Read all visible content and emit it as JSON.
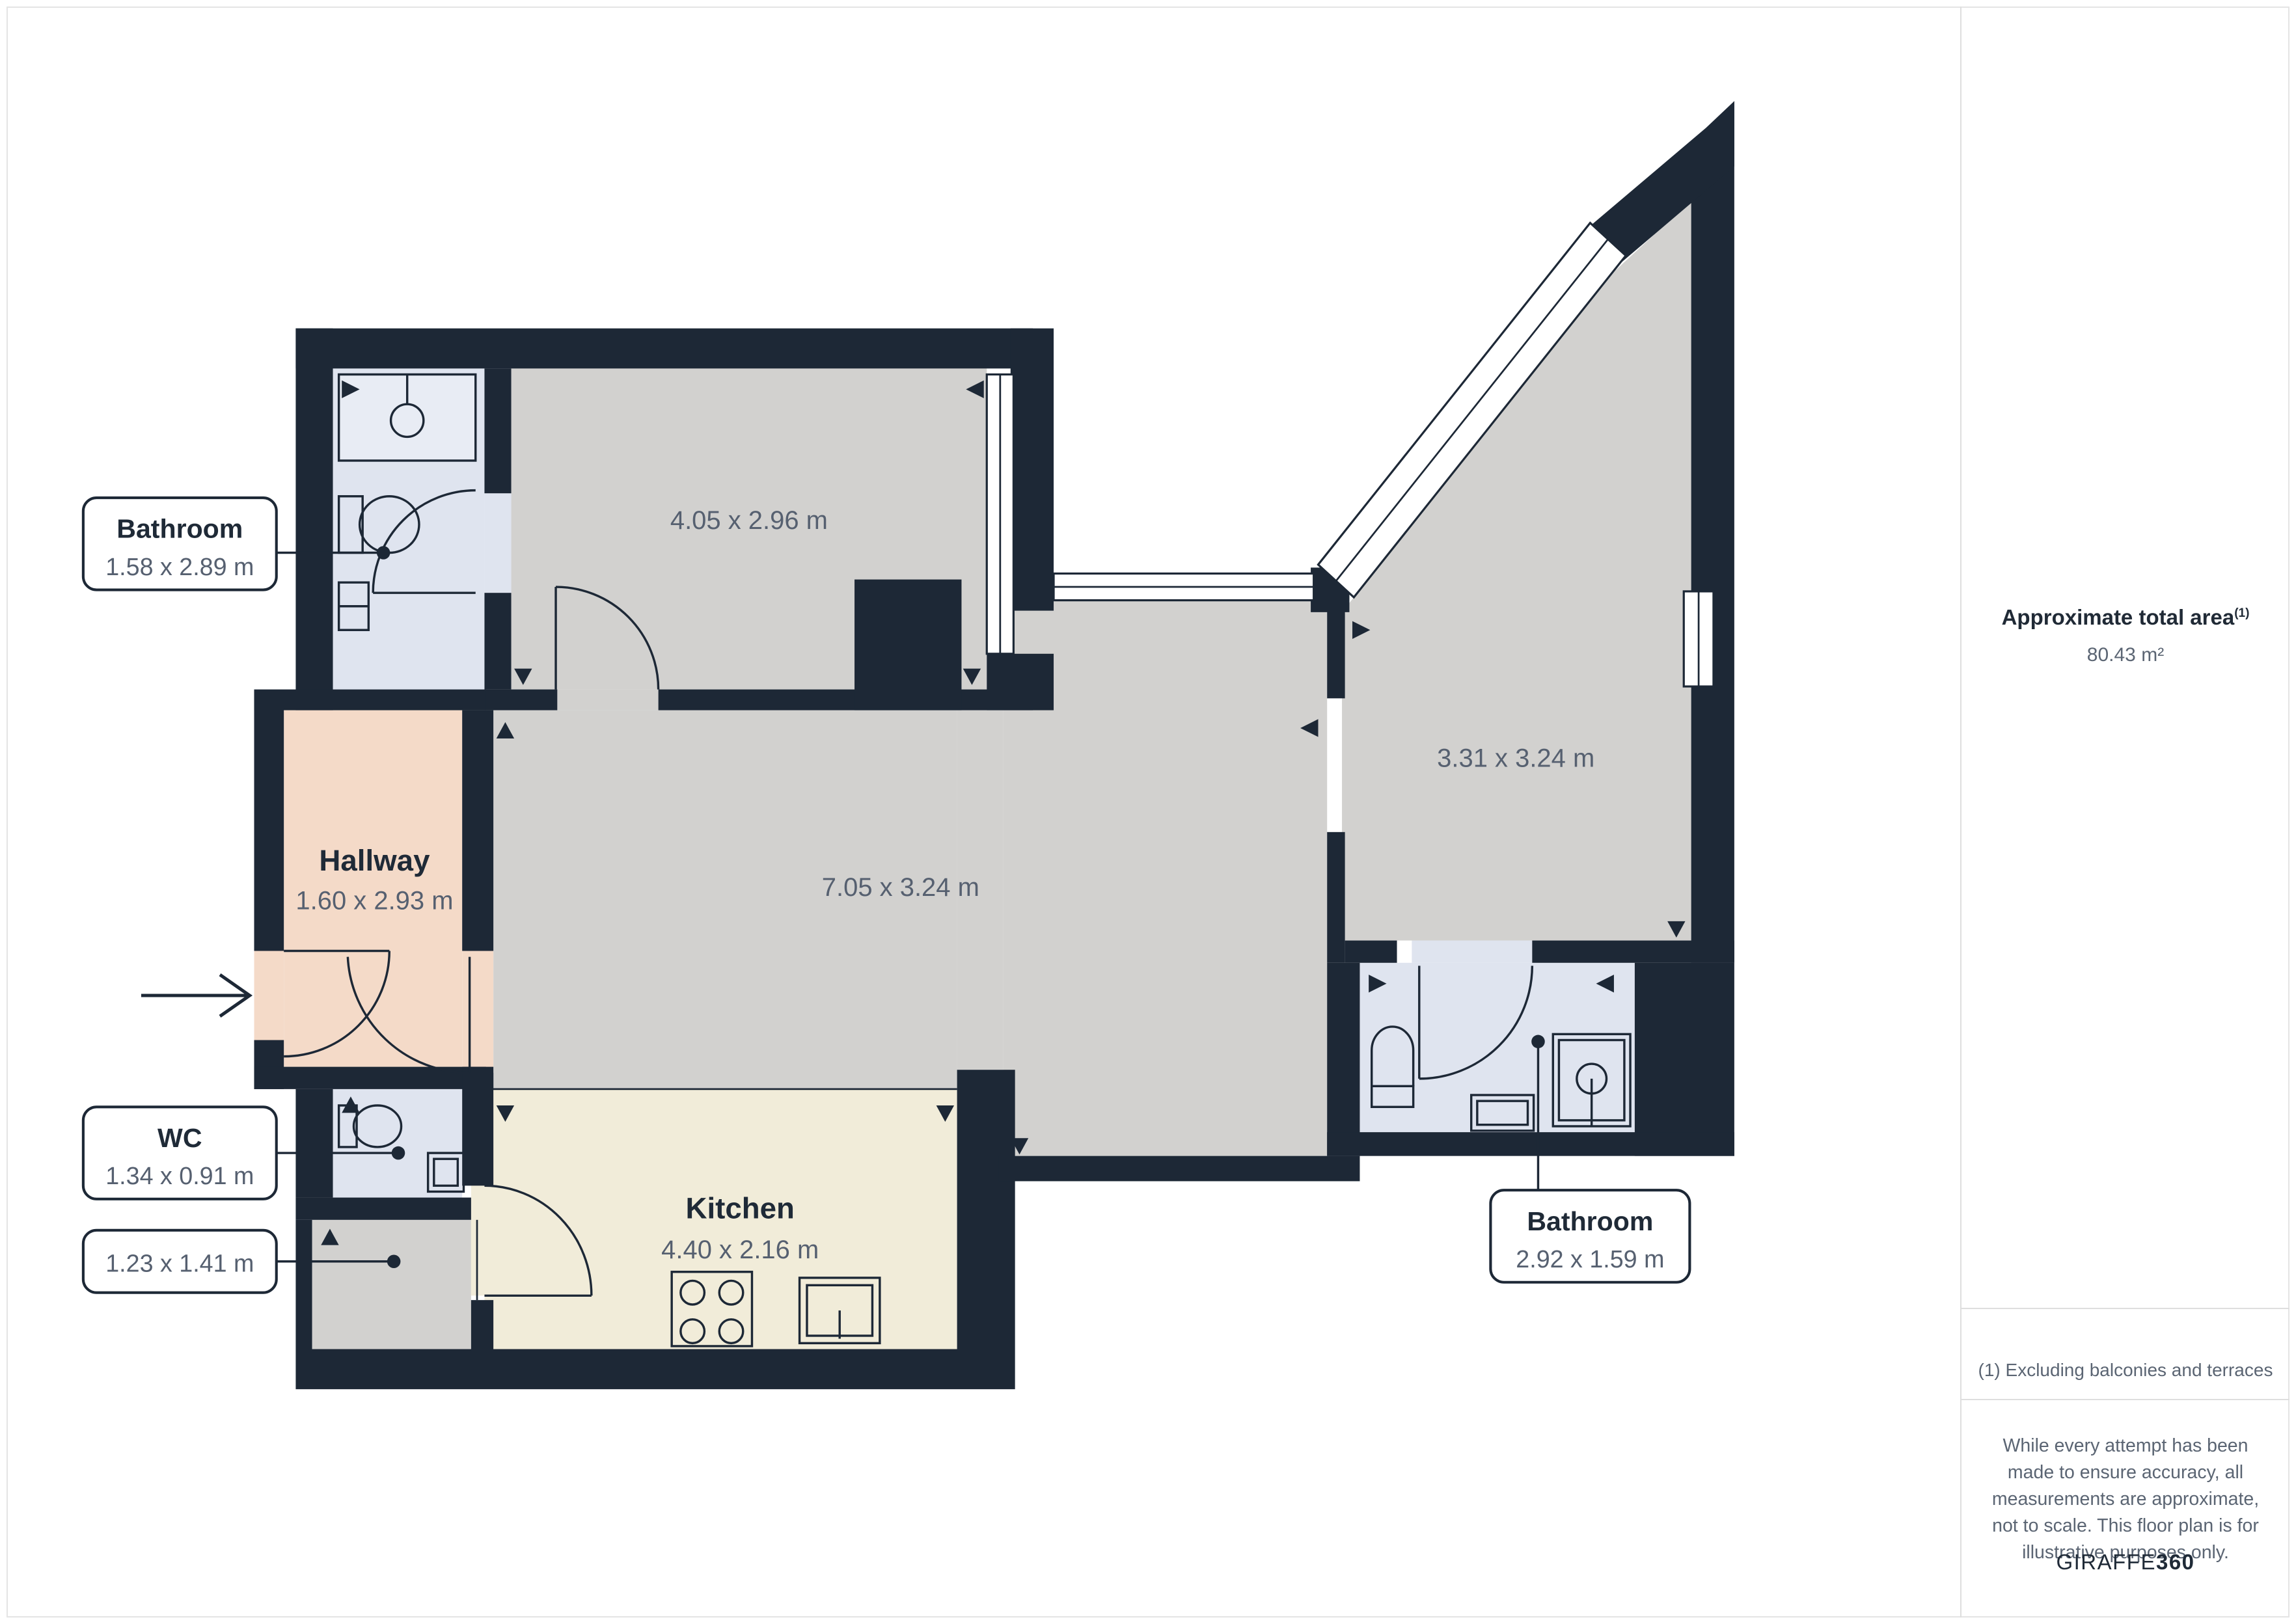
{
  "floorplan": {
    "rooms": {
      "bathroom_top": {
        "name": "Bathroom",
        "dims": "1.58 x 2.89 m"
      },
      "bedroom": {
        "dims": "4.05 x 2.96 m"
      },
      "hallway": {
        "name": "Hallway",
        "dims": "1.60 x 2.93 m"
      },
      "living": {
        "dims": "7.05 x 3.24 m"
      },
      "bedroom_right": {
        "dims": "3.31 x 3.24 m"
      },
      "wc": {
        "name": "WC",
        "dims": "1.34 x 0.91 m"
      },
      "store": {
        "dims": "1.23 x 1.41 m"
      },
      "kitchen": {
        "name": "Kitchen",
        "dims": "4.40 x 2.16 m"
      },
      "bathroom_bottom": {
        "name": "Bathroom",
        "dims": "2.92 x 1.59 m"
      }
    },
    "colors": {
      "wall": "#1d2836",
      "room_gray": "#d2d1cf",
      "room_bath": "#dfe4ef",
      "room_hall": "#f4dac8",
      "room_kitchen": "#f1ecd9",
      "divider": "#dedede",
      "dim_text": "#566070",
      "name_text": "#1f2a37"
    }
  },
  "sidebar": {
    "area_title": "Approximate total area",
    "area_footnote_marker": "(1)",
    "area_value": "80.43 m²",
    "footnote": "(1) Excluding balconies and terraces",
    "disclaimer": "While every attempt has been made to ensure accuracy, all measurements are approximate, not to scale. This floor plan is for illustrative purposes only.",
    "brand_regular": "GIRAFFE",
    "brand_bold": "360"
  }
}
